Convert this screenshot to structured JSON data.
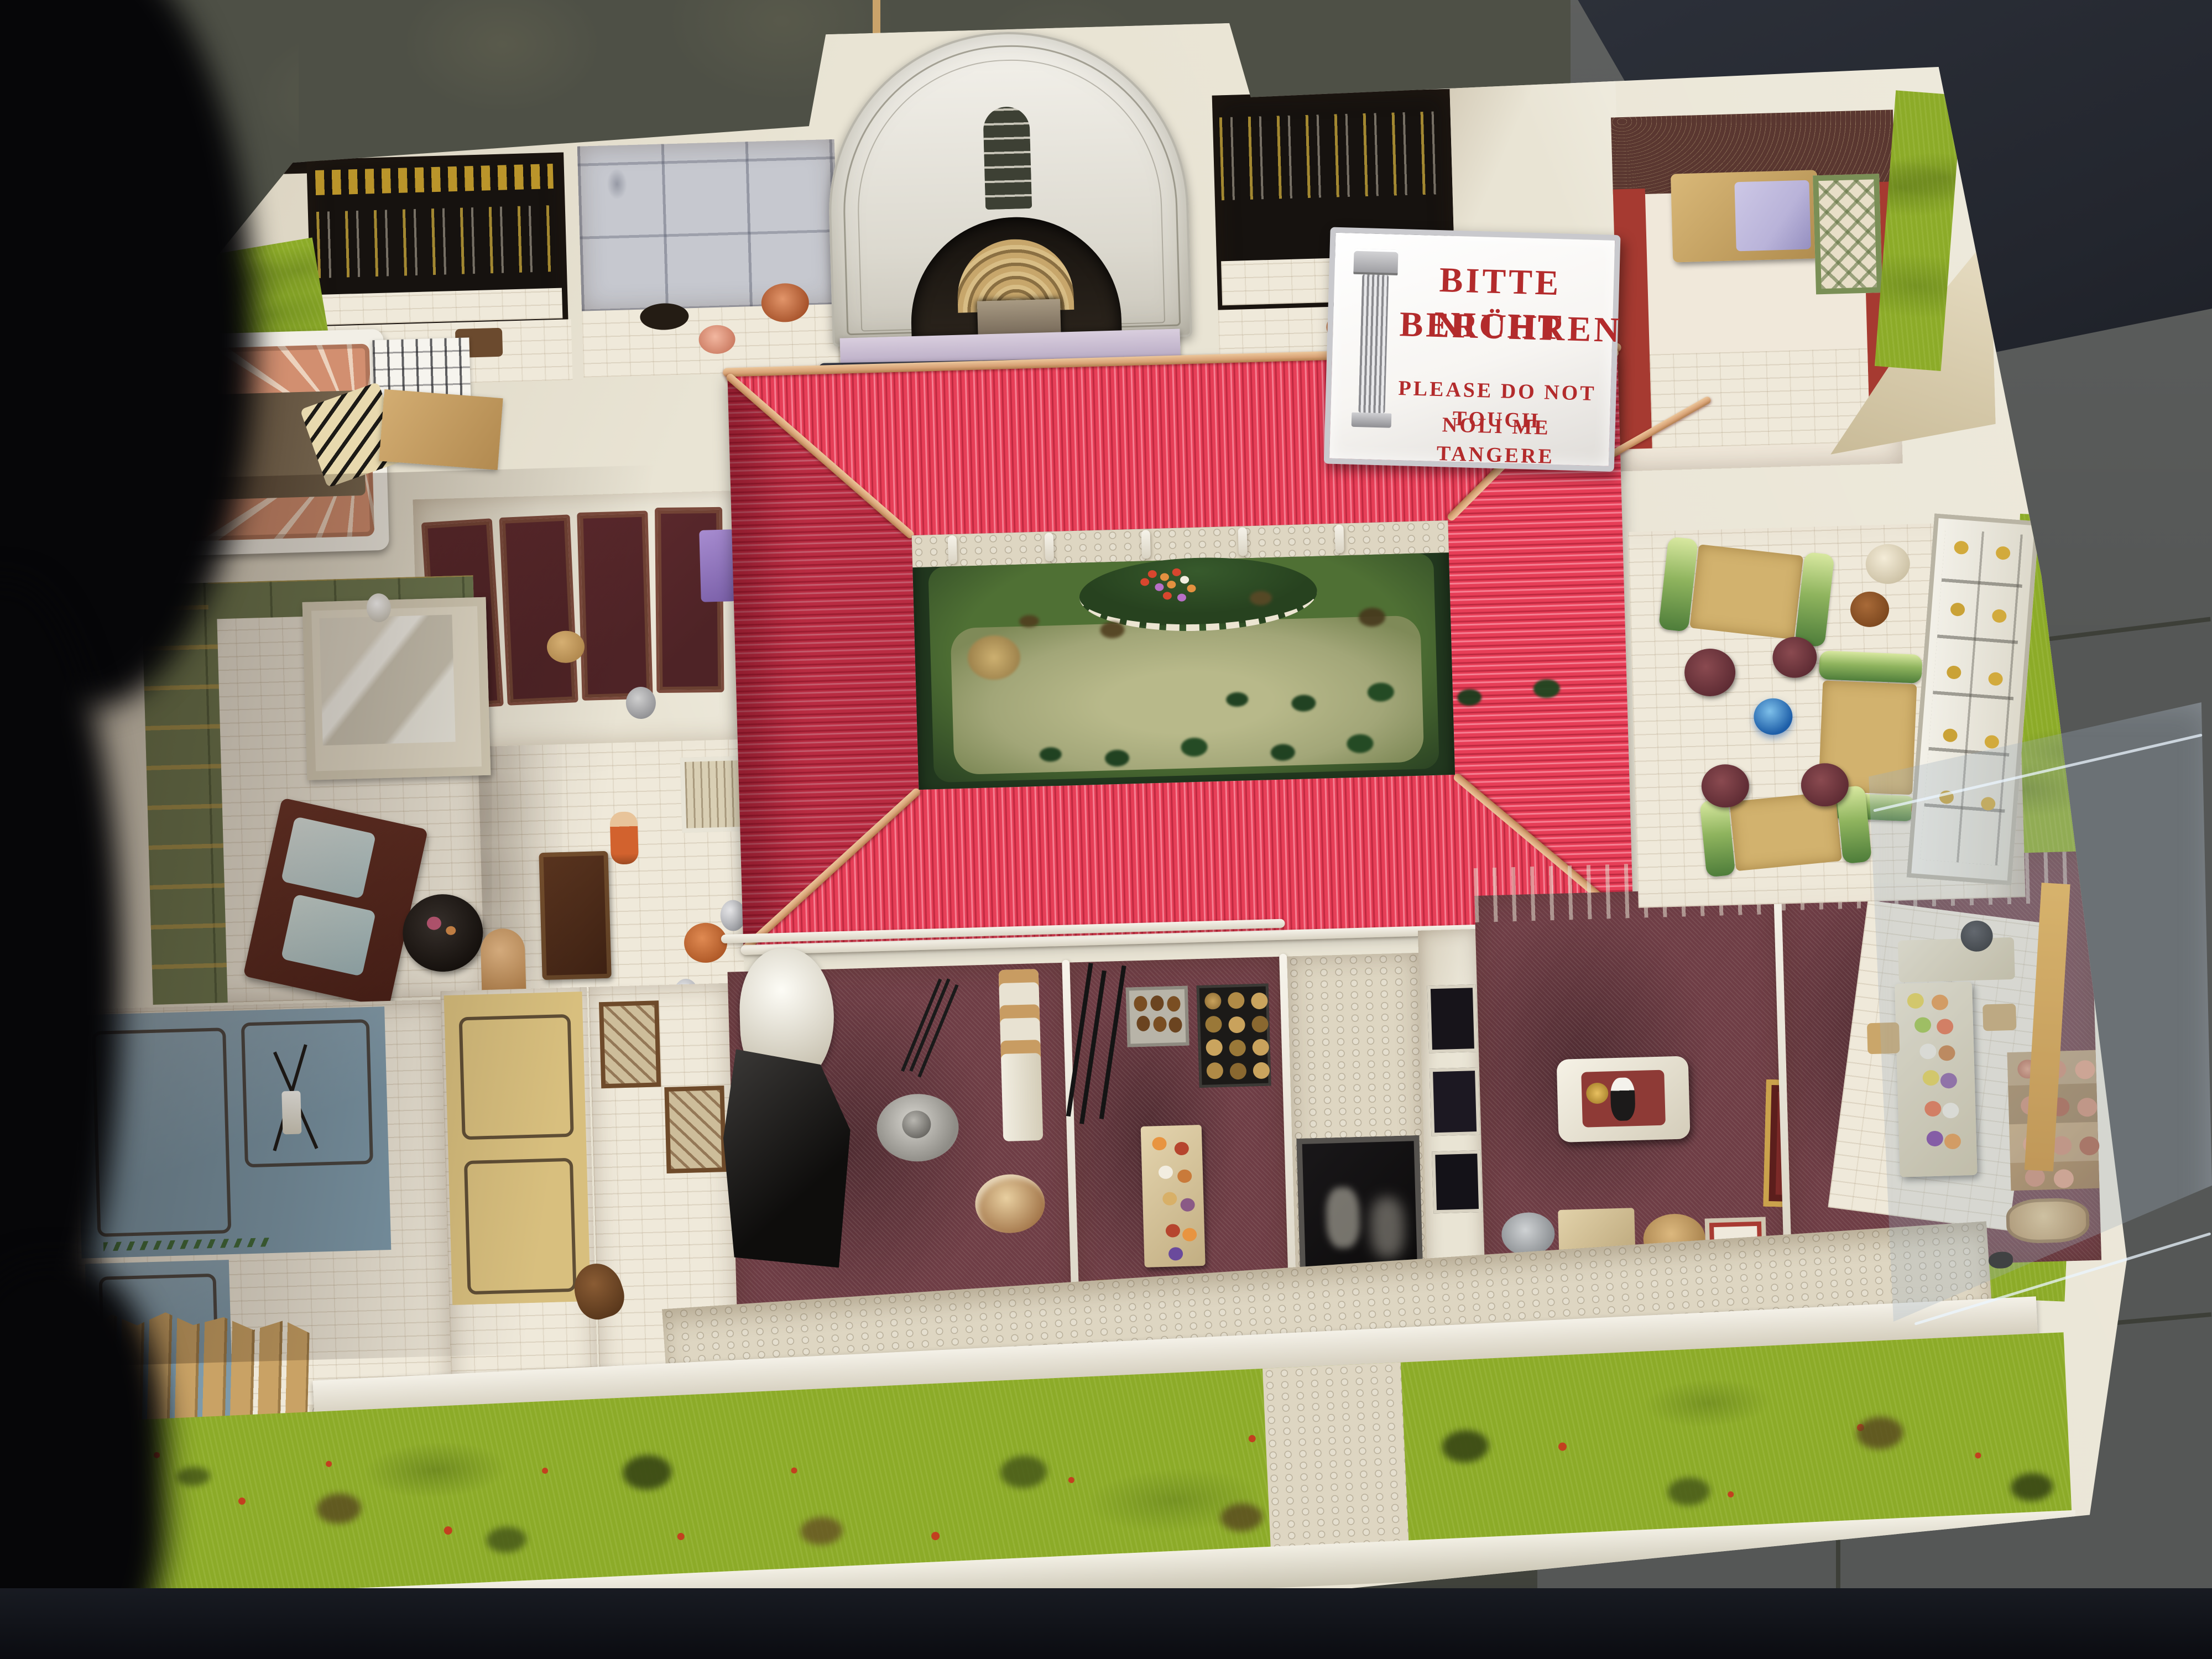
{
  "sign": {
    "line1": "BITTE NICHT",
    "line2": "BERÜHREN",
    "line3": "PLEASE DO NOT TOUCH",
    "line4": "NOLI ME TANGERE"
  },
  "colors": {
    "floor-top": "#4e5046",
    "floor-main": "#43453e",
    "floor-right": "#555756",
    "grout": "#35372f",
    "navy-slab": "#23262e",
    "black-shadow": "#060608",
    "base-white": "#e9e4d4",
    "beam-white": "#f6f3ea",
    "roof-red": "#e73e57",
    "roof-red-dark": "#bf2a41",
    "roof-red-light": "#f57f92",
    "ridge-tan": "#d8a276",
    "garden-dark": "#22381f",
    "garden-mid": "#4f7034",
    "garden-light": "#a2a678",
    "flower-red": "#d8462e",
    "flower-orange": "#e49140",
    "lawn-green": "#8cab28",
    "berry-red": "#c2401f",
    "cobble": "#ded6c2",
    "street-white": "#e5decb",
    "maroon-floor": "#6e3d45",
    "black-wall": "#16120f",
    "gold": "#c8a02c",
    "grey-panel": "#c6c8cf",
    "salmon": "#d28f70",
    "salmon-light": "#ecd2bd",
    "olive-wall": "#6d7850",
    "blue-wall": "#7d9aab",
    "tan-wall": "#d8bf7e",
    "wood": "#c9a265",
    "door-maroon": "#4e2326",
    "red-wall": "#a63a31",
    "green-couch-a": "#8fb45e",
    "green-couch-b": "#4e7d3a",
    "mattress": "#d2b26e",
    "slate-blue": "#3d4252",
    "lavender": "#b9b3d9",
    "sign-bg": "#f7f5f2",
    "sign-red": "#b32b2c",
    "sign-frame": "#c9c9cd",
    "copper": "#c06a28"
  }
}
